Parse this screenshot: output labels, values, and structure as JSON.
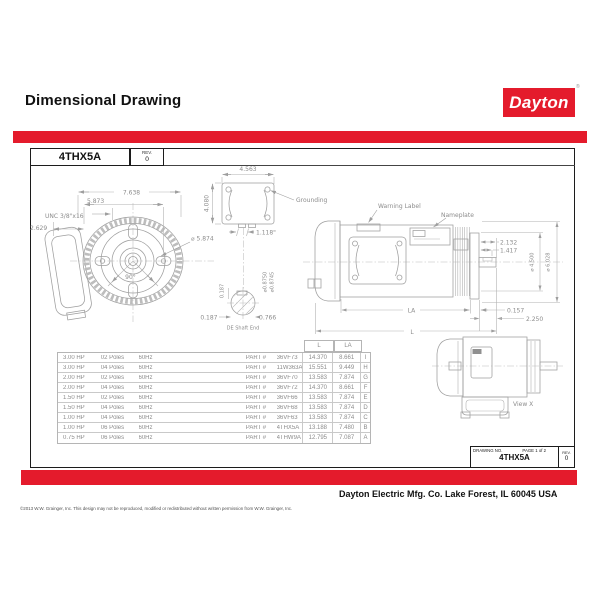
{
  "page": {
    "title": "Dimensional Drawing",
    "accent_color": "#e41b2c"
  },
  "brand": {
    "name": "Dayton",
    "registered_mark": "®"
  },
  "title_block": {
    "part_number": "4THX5A",
    "rev_label": "REV.",
    "rev_value": "0"
  },
  "drawing": {
    "front": {
      "dim_overall_width": "7.638",
      "dim_bolt_spacing": "5.873",
      "thread": "UNC 3/8\"x16",
      "dim_offset": "2.629",
      "dim_pilot_dia": "⌀ 5.874",
      "angle": "90°"
    },
    "conduit": {
      "dim_width": "4.563",
      "dim_height": "4.080",
      "dim_knockout": "1.118\"",
      "grounding": "Grounding"
    },
    "shaft": {
      "key_height": "0.187",
      "dia_max": "⌀0.8750",
      "dia_min": "⌀0.8745",
      "key_offset": "0.187",
      "key_flat": "0.766",
      "label": "DE Shaft End"
    },
    "side": {
      "warning": "Warning Label",
      "nameplate": "Nameplate",
      "dim_shaft_len": "2.132",
      "dim_key_len": "1.417",
      "dim_flange_dia": "⌀ 4.500",
      "dim_body_dia": "⌀ 6.028",
      "dim_flange_thk": "0.157",
      "dim_shaft_ext": "2.250",
      "dim_la": "LA",
      "dim_l": "L"
    },
    "view_x": {
      "label": "View X"
    }
  },
  "table": {
    "headers": {
      "l": "L",
      "la": "LA"
    },
    "part_prefix": "PART #",
    "rows": [
      {
        "hp": "3.00  HP",
        "poles": "02  Poles",
        "hz": "60Hz",
        "part": "36VF73",
        "l": "14.370",
        "la": "8.661",
        "key": "I"
      },
      {
        "hp": "3.00  HP",
        "poles": "04  Poles",
        "hz": "60Hz",
        "part": "11W363A",
        "l": "15.551",
        "la": "9.449",
        "key": "H"
      },
      {
        "hp": "2.00  HP",
        "poles": "02  Poles",
        "hz": "60Hz",
        "part": "36VF70",
        "l": "13.583",
        "la": "7.874",
        "key": "G"
      },
      {
        "hp": "2.00  HP",
        "poles": "04  Poles",
        "hz": "60Hz",
        "part": "36VF72",
        "l": "14.370",
        "la": "8.661",
        "key": "F"
      },
      {
        "hp": "1.50  HP",
        "poles": "02  Poles",
        "hz": "60Hz",
        "part": "36VF66",
        "l": "13.583",
        "la": "7.874",
        "key": "E"
      },
      {
        "hp": "1.50  HP",
        "poles": "04  Poles",
        "hz": "60Hz",
        "part": "36VF68",
        "l": "13.583",
        "la": "7.874",
        "key": "D"
      },
      {
        "hp": "1.00  HP",
        "poles": "04  Poles",
        "hz": "60Hz",
        "part": "36VF63",
        "l": "13.583",
        "la": "7.874",
        "key": "C"
      },
      {
        "hp": "1.00  HP",
        "poles": "06  Poles",
        "hz": "60Hz",
        "part": "4THX5A",
        "l": "13.188",
        "la": "7.480",
        "key": "B"
      },
      {
        "hp": "0.75  HP",
        "poles": "06  Poles",
        "hz": "60Hz",
        "part": "4THW9A",
        "l": "12.795",
        "la": "7.087",
        "key": "A"
      }
    ]
  },
  "drawing_block": {
    "drawing_no_label": "DRAWING NO.",
    "page_label": "PAGE  1  of  2",
    "part_number": "4THX5A",
    "rev_label": "REV.",
    "rev_value": "0"
  },
  "footer": {
    "company": "Dayton Electric Mfg. Co.  Lake Forest, IL  60045  USA",
    "copyright": "©2013 W.W. Grainger, Inc.   This design may not be reproduced, modified or redistributed without written permission from W.W. Grainger, Inc."
  }
}
